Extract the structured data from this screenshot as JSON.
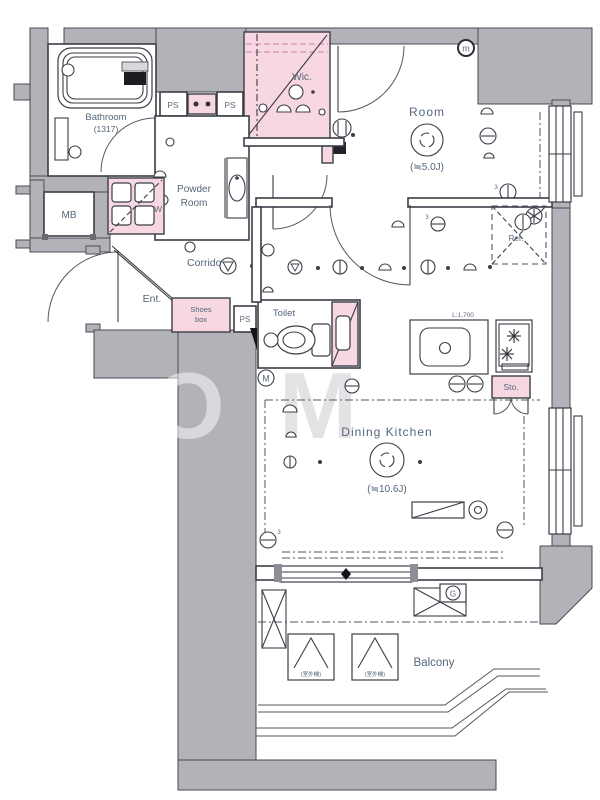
{
  "plan": {
    "bathroom": {
      "name": "Bathroom",
      "size": "(1317)"
    },
    "powder_room": {
      "line1": "Powder",
      "line2": "Room"
    },
    "wic": {
      "name": "Wic."
    },
    "room": {
      "name": "Room",
      "size": "(≒5.0J)"
    },
    "mb": "MB",
    "corridor": "Corridor",
    "entrance": "Ent.",
    "shoes_box": {
      "line1": "Shoes",
      "line2": "box"
    },
    "ps": [
      "PS",
      "PS",
      "PS"
    ],
    "toilet": "Toilet",
    "washer": "W",
    "refrigerator": "Ref.",
    "storage": "Sto.",
    "kitchen_counter_length": "L:1,700",
    "dining_kitchen": {
      "name": "Dining Kitchen",
      "size": "(≒10.6J)"
    },
    "balcony": "Balcony",
    "meters": {
      "m": "m",
      "M": "M",
      "G": "G"
    },
    "ac_unit_labels": [
      "(室外機)",
      "(室外機)"
    ],
    "n3": [
      "3",
      "3",
      "3"
    ],
    "watermark": {
      "part1": "O",
      "part2": "M"
    }
  },
  "colors": {
    "wall": "#b2b3b9",
    "accent_pink": "#f7d8e2",
    "line": "#3c3d46",
    "text": "#54667a"
  }
}
